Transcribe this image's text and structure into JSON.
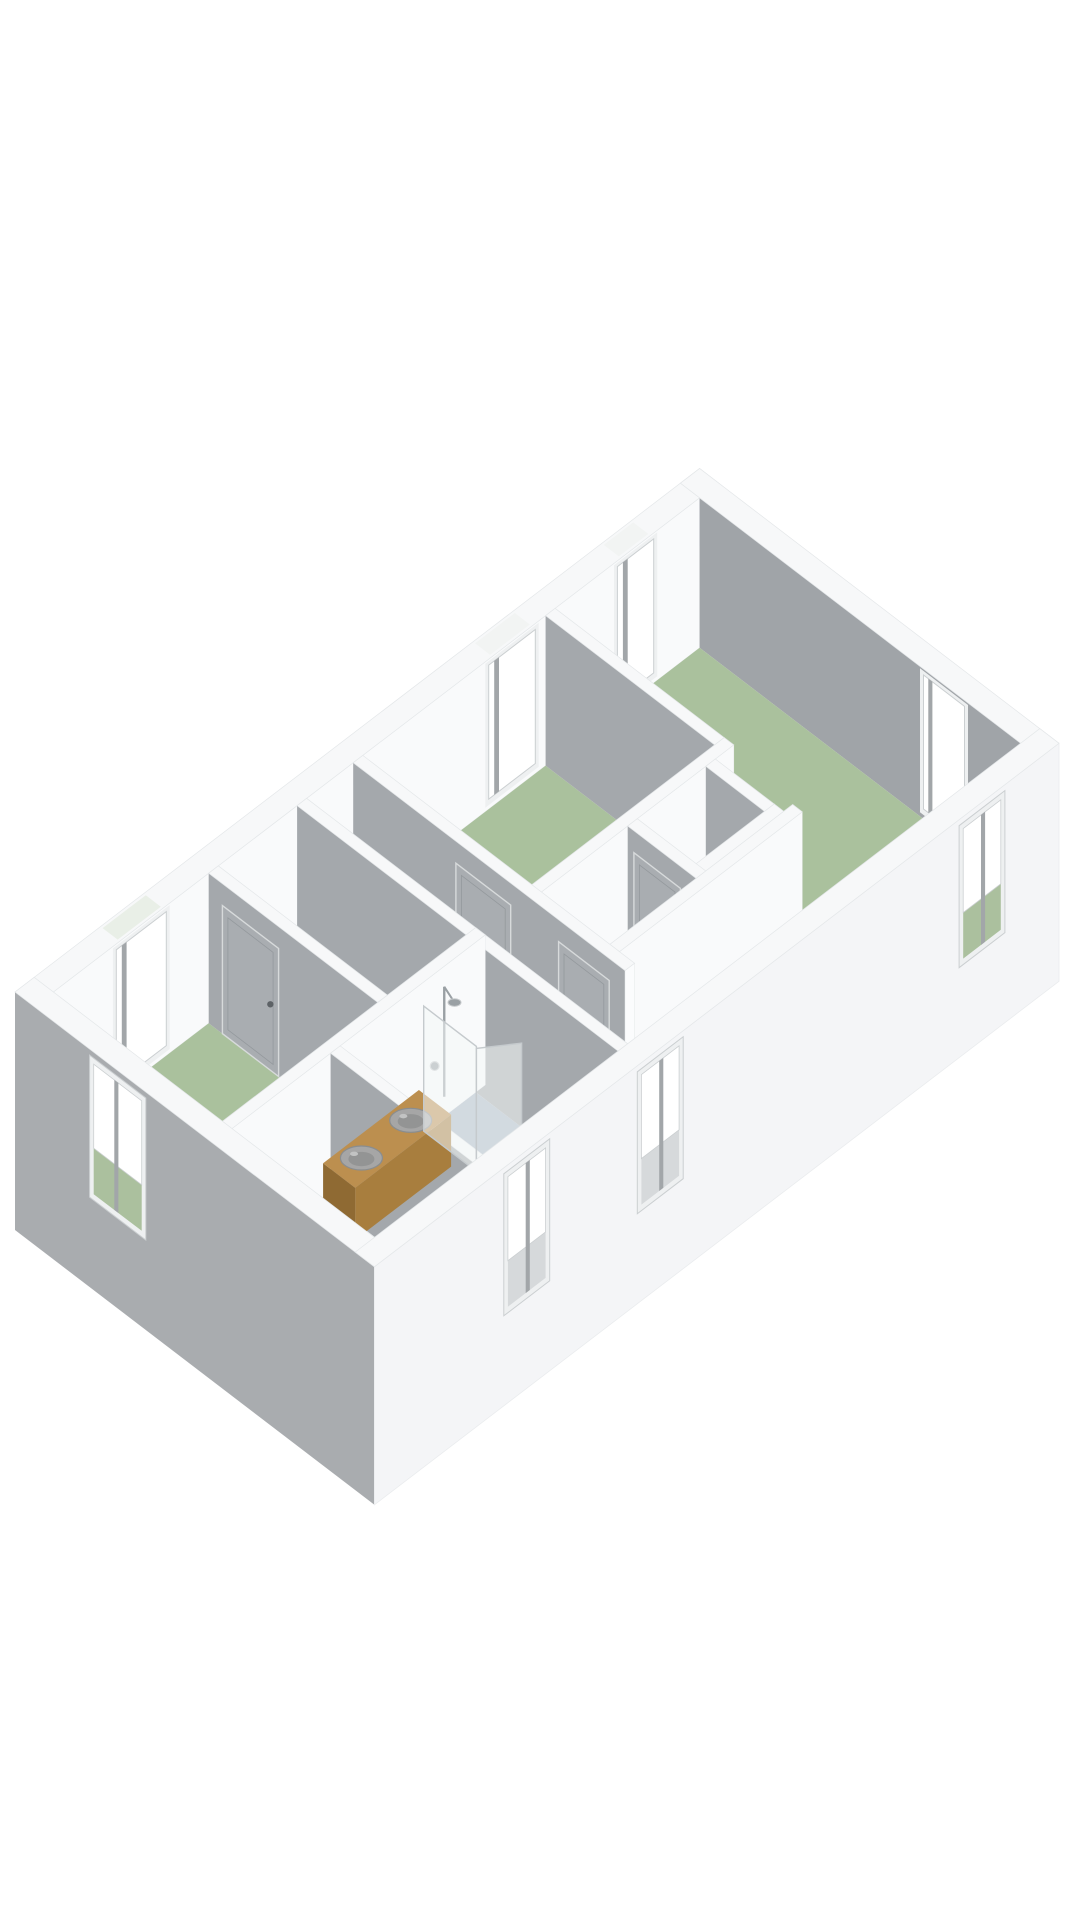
{
  "meta": {
    "aria_label": "3D floor plan rendering of an apartment floor with three bedrooms, corridor, bathroom and storage rooms",
    "render_type": "3d-floorplan"
  },
  "palette": {
    "bg": "#ffffff",
    "top": "#f7f8f9",
    "topStroke": "#e4e7e9",
    "wallLit": "#f9fafb",
    "capWhite": "#fbfcfd",
    "innerGray": "#a4a8ac",
    "grayFar": "#a0a4a8",
    "grayNear": "#a9acaf",
    "extWhite": "#f4f5f7",
    "extStroke": "#eaecee",
    "floorGreen": "#aac19d",
    "floorTan": "#b5aa96",
    "floorBath": "#a9b5c4",
    "floorWhite": "#f1f2f3",
    "doorFill": "#a9adb1",
    "doorFrame": "#d7dadb",
    "doorInner": "#94999d",
    "handle": "#5d6266",
    "winJamb": "#eef0f1",
    "winVoid": "#ffffff",
    "winStroke": "#cbcfd1",
    "winPost": "#a2a6a9",
    "throughGray": "#d6d9db",
    "throughGreen": "#abc09e",
    "gapGreen": "#e9efe7",
    "gapWhite": "#f2f4f3",
    "wood": "#bc8f4f",
    "woodSide": "#a87e3e",
    "woodCap": "#8f6a33",
    "sink": "#a6a6a6",
    "sinkRim": "#8a8d8f",
    "sinkInner": "#939494",
    "sinkHi": "#c2c3c3",
    "glass": "rgba(244,247,248,0.55)",
    "glassStroke": "#c5cacd",
    "chrome": "#9aa0a4",
    "chromeHi": "#c9ccce"
  },
  "projection": {
    "origin": [
      15,
      1142
    ],
    "ux": [
      68.46,
      -52.35
    ],
    "uy": [
      68.46,
      52.34
    ],
    "wall_h": 150,
    "slab": 88,
    "door_h": 128
  },
  "floorplan": {
    "outer": {
      "length": 10.0,
      "width": 5.25,
      "ext_t": 0.28,
      "int_t": 0.14
    },
    "floors": [
      {
        "name": "floor-bedroom-right",
        "room": "bedroom-right",
        "color": "floorGreen",
        "poly": [
          [
            7.61,
            0.28
          ],
          [
            9.72,
            0.28
          ],
          [
            9.72,
            4.97
          ],
          [
            4.94,
            4.97
          ],
          [
            4.94,
            4.03
          ],
          [
            7.61,
            4.03
          ]
        ]
      },
      {
        "name": "floor-bedroom-middle",
        "room": "bedroom-middle",
        "color": "floorGreen",
        "poly": [
          [
            4.8,
            0.28
          ],
          [
            7.47,
            0.28
          ],
          [
            7.47,
            2.75
          ],
          [
            4.8,
            2.75
          ]
        ]
      },
      {
        "name": "floor-bedroom-left",
        "room": "bedroom-left",
        "color": "floorGreen",
        "poly": [
          [
            0.28,
            0.28
          ],
          [
            2.55,
            0.28
          ],
          [
            2.55,
            2.75
          ],
          [
            0.28,
            2.75
          ]
        ]
      },
      {
        "name": "floor-stairwell",
        "room": "stairwell",
        "color": "floorWhite",
        "poly": [
          [
            2.69,
            0.28
          ],
          [
            3.84,
            0.28
          ],
          [
            3.84,
            2.75
          ],
          [
            2.69,
            2.75
          ]
        ]
      },
      {
        "name": "floor-corridor",
        "room": "corridor",
        "color": "floorTan",
        "poly": [
          [
            3.98,
            0.28
          ],
          [
            4.66,
            0.28
          ],
          [
            4.66,
            4.97
          ],
          [
            3.98,
            4.97
          ]
        ]
      },
      {
        "name": "floor-landing",
        "room": "landing",
        "color": "floorWhite",
        "poly": [
          [
            4.8,
            2.89
          ],
          [
            6.06,
            2.89
          ],
          [
            6.06,
            3.89
          ],
          [
            4.8,
            3.89
          ]
        ]
      },
      {
        "name": "floor-closet",
        "room": "closet",
        "color": "floorWhite",
        "poly": [
          [
            6.2,
            2.89
          ],
          [
            7.2,
            2.89
          ],
          [
            7.2,
            3.75
          ],
          [
            6.2,
            3.75
          ]
        ]
      },
      {
        "name": "floor-bathroom",
        "room": "bathroom",
        "color": "floorBath",
        "poly": [
          [
            1.86,
            2.89
          ],
          [
            3.84,
            2.89
          ],
          [
            3.84,
            4.97
          ],
          [
            1.86,
            4.97
          ]
        ]
      },
      {
        "name": "floor-storage-corner",
        "room": "storage",
        "color": "floorWhite",
        "poly": [
          [
            0.28,
            2.89
          ],
          [
            1.72,
            2.89
          ],
          [
            1.72,
            4.97
          ],
          [
            0.28,
            4.97
          ]
        ]
      }
    ],
    "back_wall": {
      "name": "wall-exterior-back",
      "face": {
        "y": 0.28,
        "x0": 0.28,
        "x1": 9.72
      },
      "top": {
        "x0": 0.0,
        "x1": 10.0,
        "y0": 0.0,
        "y1": 0.28
      },
      "windows": [
        {
          "name": "window-back-left",
          "a0": 1.2,
          "a1": 1.93,
          "gap": "gapGreen"
        },
        {
          "name": "window-back-middle",
          "a0": 6.64,
          "a1": 7.32,
          "gap": "gapWhite"
        },
        {
          "name": "window-back-right",
          "a0": 8.52,
          "a1": 9.05,
          "gap": "gapWhite"
        }
      ]
    },
    "right_wall": {
      "name": "wall-exterior-right",
      "face": {
        "x": 9.72,
        "y0": 0.28,
        "y1": 5.25
      },
      "top": {
        "x0": 9.72,
        "x1": 10.0,
        "y0": 0.0,
        "y1": 5.25
      },
      "windows": [
        {
          "name": "window-right-end",
          "a0": 3.55,
          "a1": 4.15
        }
      ]
    },
    "inner_walls": [
      {
        "name": "wall-middle-big",
        "type": "x",
        "x0": 7.47,
        "x1": 7.61,
        "y0": 0.28,
        "y1": 2.75,
        "doors": []
      },
      {
        "name": "wall-middle-bottom",
        "type": "y",
        "x0": 4.66,
        "x1": 7.61,
        "y0": 2.75,
        "y1": 2.89,
        "doors": []
      },
      {
        "name": "wall-closet-right",
        "type": "x",
        "x0": 7.2,
        "x1": 7.34,
        "y0": 2.89,
        "y1": 3.75,
        "doors": []
      },
      {
        "name": "wall-closet-bottom",
        "type": "y",
        "x0": 6.06,
        "x1": 7.34,
        "y0": 3.75,
        "y1": 3.89,
        "doors": []
      },
      {
        "name": "wall-closet-left",
        "type": "x",
        "x0": 6.06,
        "x1": 6.2,
        "y0": 2.89,
        "y1": 3.89,
        "doors": [
          {
            "name": "door-closet",
            "a0": 2.98,
            "a1": 3.66,
            "handle": 3.52
          }
        ]
      },
      {
        "name": "wall-arm-top",
        "type": "y",
        "x0": 4.8,
        "x1": 7.47,
        "y0": 3.89,
        "y1": 4.03,
        "doors": []
      },
      {
        "name": "wall-corridor-right",
        "type": "x",
        "x0": 4.66,
        "x1": 4.8,
        "y0": 0.28,
        "y1": 4.25,
        "doors": [
          {
            "name": "door-bedroom-middle",
            "a0": 1.78,
            "a1": 2.58,
            "handle": 2.44
          },
          {
            "name": "door-landing",
            "a0": 3.28,
            "a1": 4.02,
            "handle": 3.9
          }
        ]
      },
      {
        "name": "wall-corridor-left",
        "type": "x",
        "x0": 3.84,
        "x1": 3.98,
        "y0": 0.28,
        "y1": 4.97,
        "doors": []
      },
      {
        "name": "wall-bedroom-left-right",
        "type": "x",
        "x0": 2.55,
        "x1": 2.69,
        "y0": 0.28,
        "y1": 2.75,
        "doors": [
          {
            "name": "door-bedroom-left",
            "a0": 0.48,
            "a1": 1.3,
            "handle": 1.18
          }
        ]
      },
      {
        "name": "wall-south-band",
        "type": "y",
        "x0": 0.28,
        "x1": 3.98,
        "y0": 2.75,
        "y1": 2.89,
        "doors": []
      },
      {
        "name": "wall-bathroom-left",
        "type": "x",
        "x0": 1.72,
        "x1": 1.86,
        "y0": 2.89,
        "y1": 4.97,
        "doors": []
      }
    ],
    "fixtures": {
      "counter": {
        "name": "bathroom-counter",
        "x0": 1.55,
        "x1": 2.95,
        "y0": 2.95,
        "y1": 3.42,
        "h": 52
      },
      "sinks": [
        {
          "name": "sink-basin-1",
          "x": 1.88,
          "y": 3.18,
          "rx": 21,
          "ry": 12
        },
        {
          "name": "sink-basin-2",
          "x": 2.6,
          "y": 3.18,
          "rx": 21,
          "ry": 12
        }
      ],
      "glass_panel": {
        "name": "shower-glass-panel",
        "x": 3.06,
        "y0": 2.91,
        "y1": 3.68,
        "z0": 3,
        "z1": 128
      },
      "glass_door": {
        "name": "shower-glass-door",
        "x0": 3.06,
        "y0": 3.68,
        "x1": 3.44,
        "y1": 3.96,
        "z0": 3,
        "z1": 126
      },
      "shower": {
        "name": "shower-set",
        "pole_x": 3.3,
        "pole_y": 2.97,
        "z0": 28,
        "z1": 138,
        "head_y": 3.12,
        "head_z": 130,
        "mixer_x": 3.16,
        "mixer_z": 66
      }
    },
    "left_wall": {
      "name": "wall-exterior-left",
      "face": {
        "x": 0.0,
        "y0": 0.0,
        "y1": 5.25
      },
      "top": {
        "x0": 0.0,
        "x1": 0.28,
        "y0": 0.0,
        "y1": 5.25
      },
      "windows": [
        {
          "name": "window-left-end",
          "a0": 1.15,
          "a1": 1.85,
          "through": "throughGreen"
        }
      ]
    },
    "front_wall": {
      "name": "wall-exterior-front",
      "face": {
        "y": 5.25,
        "x0": 0.0,
        "x1": 10.0
      },
      "top": {
        "x0": 0.0,
        "x1": 10.0,
        "y0": 4.97,
        "y1": 5.25
      },
      "windows": [
        {
          "name": "window-front-bathroom",
          "a0": 1.95,
          "a1": 2.5,
          "through": "throughGray"
        },
        {
          "name": "window-front-corridor",
          "a0": 3.9,
          "a1": 4.45,
          "through": "throughGray"
        },
        {
          "name": "window-front-bedroom-right",
          "a0": 8.6,
          "a1": 9.15,
          "through": "throughGreen"
        }
      ]
    }
  }
}
